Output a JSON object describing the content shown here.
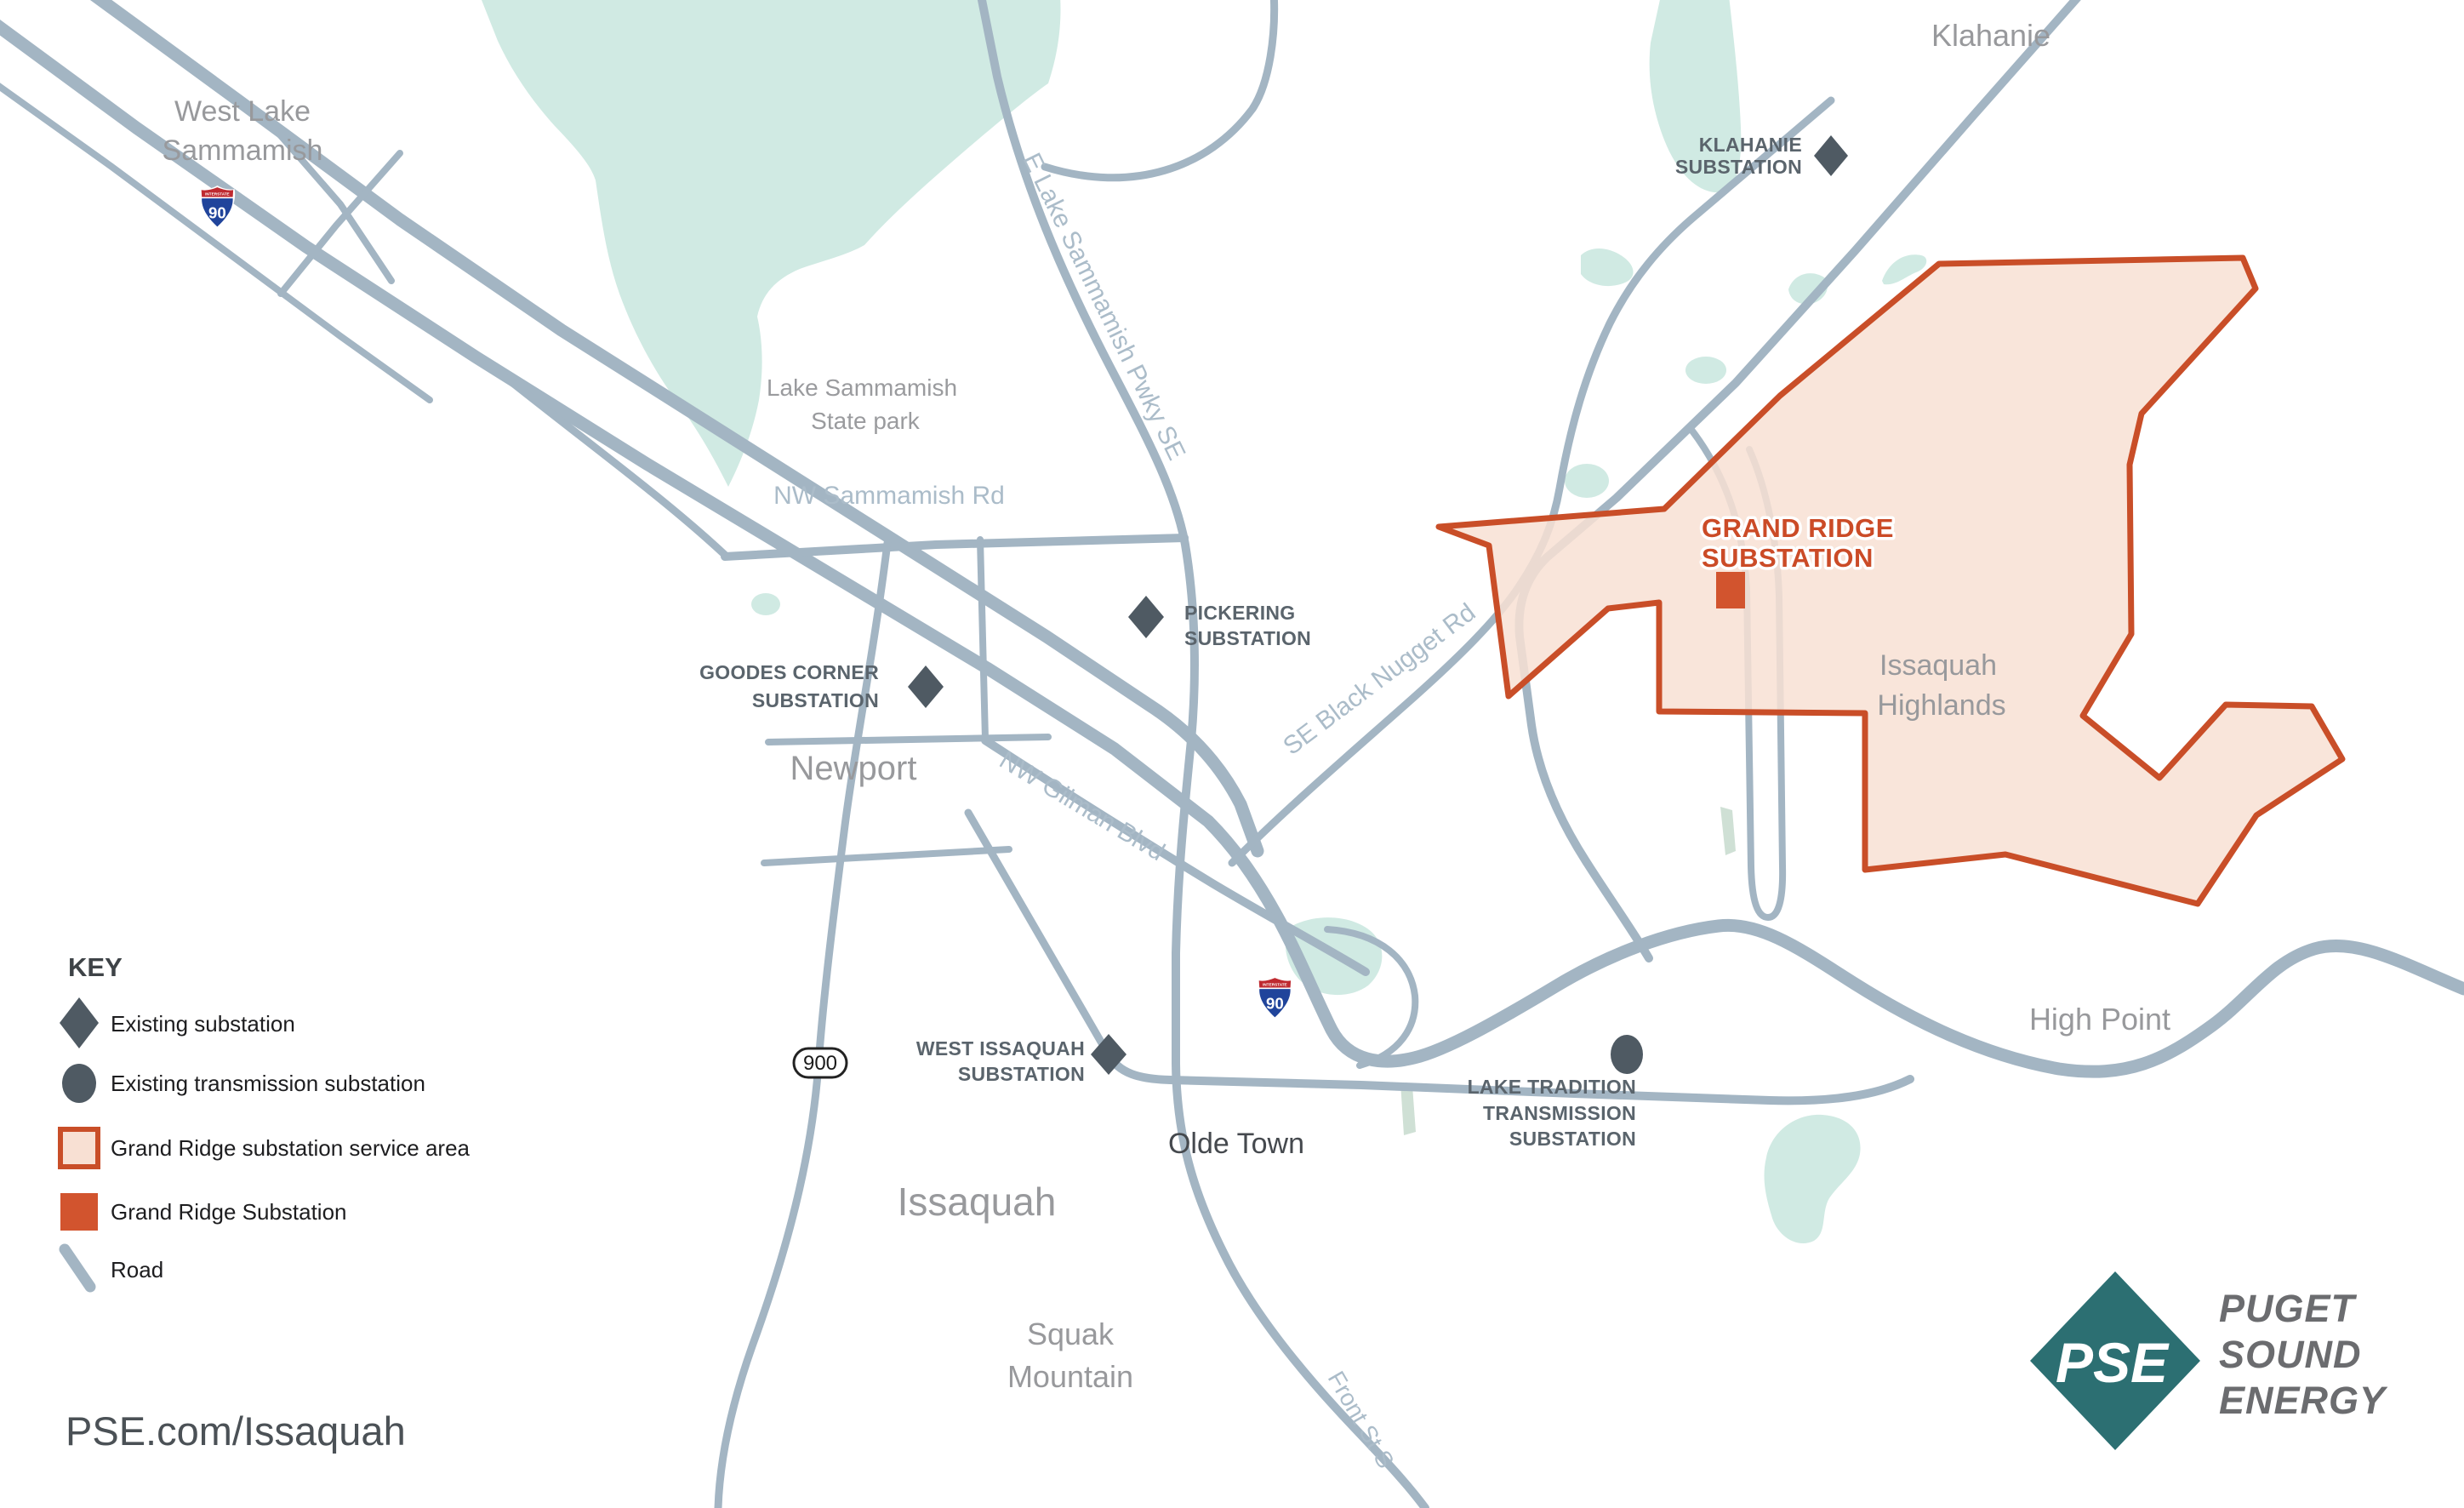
{
  "title": "Grand Ridge Substation service area map",
  "colors": {
    "service_fill": "#f8e0d3",
    "service_border": "#c94e28",
    "marker_slate": "#4f5a63",
    "road": "#a3b5c3",
    "water": "#d0eae3",
    "pse_teal": "#2c6f72",
    "orange_square": "#d2542e",
    "label_gray": "#98999c"
  },
  "places": {
    "west_lake": {
      "l1": "West Lake",
      "l2": "Sammamish"
    },
    "klahanie": "Klahanie",
    "state_park": {
      "l1": "Lake Sammamish",
      "l2": "State park"
    },
    "newport": "Newport",
    "issaquah": "Issaquah",
    "squak": {
      "l1": "Squak",
      "l2": "Mountain"
    },
    "olde_town": "Olde Town",
    "high_point": "High Point",
    "highlands": {
      "l1": "Issaquah",
      "l2": "Highlands"
    }
  },
  "roads": {
    "nw_sammamish": "NW Sammamish Rd",
    "e_lake_pkwy": "E Lake Sammamish Pwky SE",
    "gilman": "NW Gilman Blvd",
    "black_nugget": "SE Black Nugget Rd",
    "front_st": "Front St S"
  },
  "substations": {
    "klahanie": {
      "l1": "KLAHANIE",
      "l2": "SUBSTATION"
    },
    "pickering": {
      "l1": "PICKERING",
      "l2": "SUBSTATION"
    },
    "goodes": {
      "l1": "GOODES CORNER",
      "l2": "SUBSTATION"
    },
    "west_issaquah": {
      "l1": "WEST ISSAQUAH",
      "l2": "SUBSTATION"
    },
    "lake_tradition": {
      "l1": "LAKE TRADITION",
      "l2": "TRANSMISSION",
      "l3": "SUBSTATION"
    },
    "grand_ridge": {
      "l1": "GRAND RIDGE",
      "l2": "SUBSTATION"
    }
  },
  "shields": {
    "interstate": "INTERSTATE",
    "i90": "90",
    "sr900": "900"
  },
  "legend": {
    "title": "KEY",
    "existing": "Existing substation",
    "transmission": "Existing transmission substation",
    "service_area": "Grand Ridge substation service area",
    "grand_ridge": "Grand Ridge Substation",
    "road": "Road"
  },
  "footer": {
    "url": "PSE.com/Issaquah"
  },
  "logo": {
    "monogram": "PSE",
    "l1": "PUGET",
    "l2": "SOUND",
    "l3": "ENERGY"
  }
}
